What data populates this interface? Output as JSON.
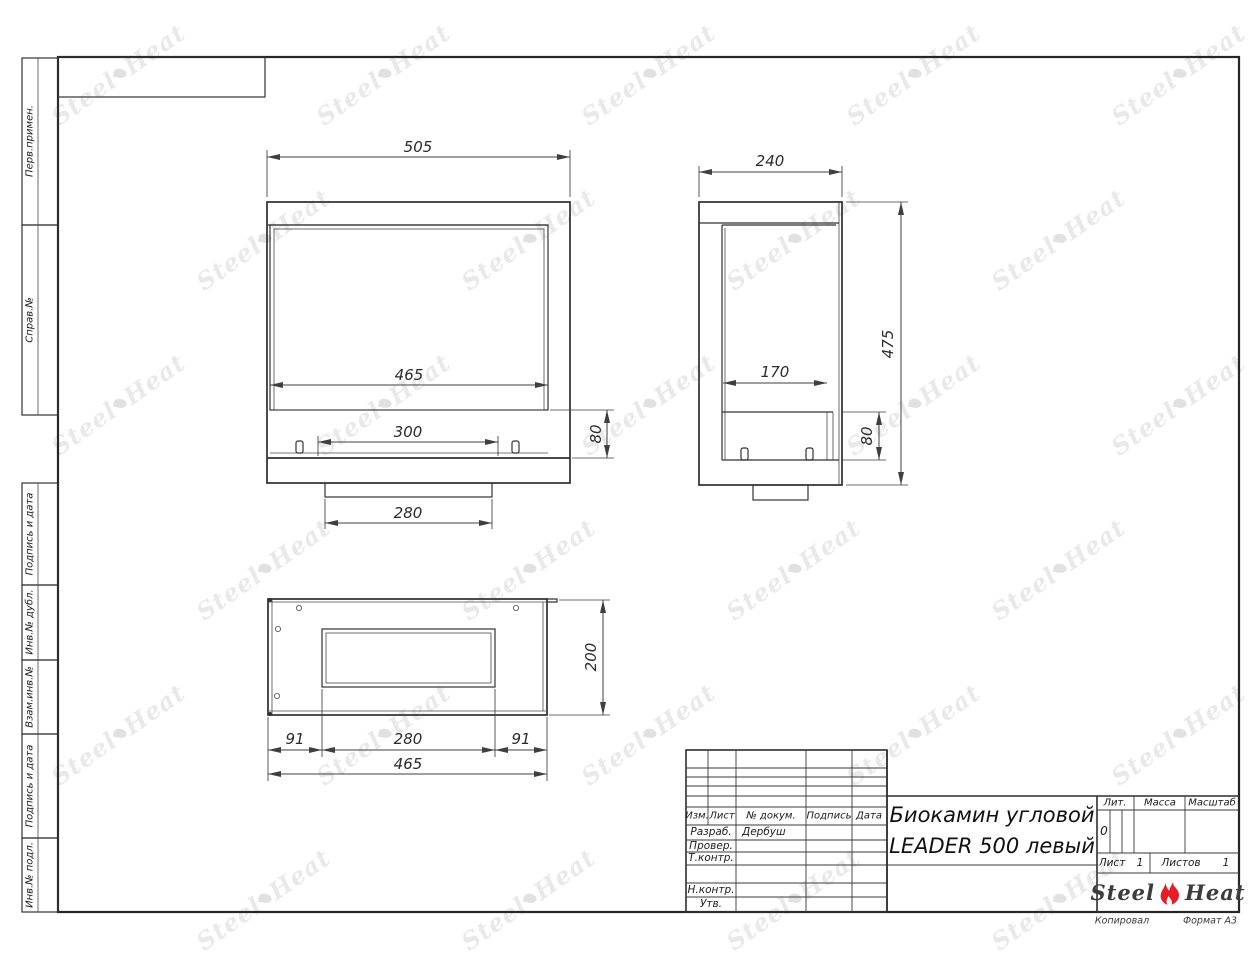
{
  "watermark": {
    "steel": "Steel",
    "heat": "Heat"
  },
  "margin": {
    "labels": [
      "Перв.примен.",
      "Справ.№",
      "Подпись и дата",
      "Инв.№ дубл.",
      "Взам.инв.№",
      "Подпись и дата",
      "Инв.№ подл."
    ]
  },
  "views": {
    "front": {
      "overall_width": "505",
      "glass_width": "465",
      "burner_width": "300",
      "base_width": "280",
      "shelf_height": "80"
    },
    "side": {
      "overall_depth": "240",
      "overall_height": "475",
      "inner_depth": "170",
      "shelf_height": "80"
    },
    "top": {
      "body_depth": "200",
      "left_offset": "91",
      "opening_width": "280",
      "right_offset": "91",
      "body_width": "465"
    }
  },
  "titleblock": {
    "header": {
      "izm": "Изм.",
      "list": "Лист",
      "doc": "№ докум.",
      "podpis": "Подпись",
      "data": "Дата"
    },
    "rows": {
      "razrab_label": "Разраб.",
      "razrab_name": "Дербуш",
      "prover_label": "Провер.",
      "tkontr_label": "Т.контр.",
      "nkontr_label": "Н.контр.",
      "utv_label": "Утв."
    },
    "title_line1": "Биокамин угловой",
    "title_line2": "LEADER 500 левый",
    "lit_label": "Лит.",
    "lit_value": "0",
    "massa_label": "Масса",
    "masshtab_label": "Масштаб",
    "sheet": {
      "list_label": "Лист",
      "list_value": "1",
      "listov_label": "Листов",
      "listov_value": "1"
    },
    "logo": {
      "steel": "Steel",
      "heat": "Heat",
      "flame_color": "#e31e24"
    },
    "footer": {
      "copied": "Копировал",
      "format": "Формат А3"
    }
  }
}
